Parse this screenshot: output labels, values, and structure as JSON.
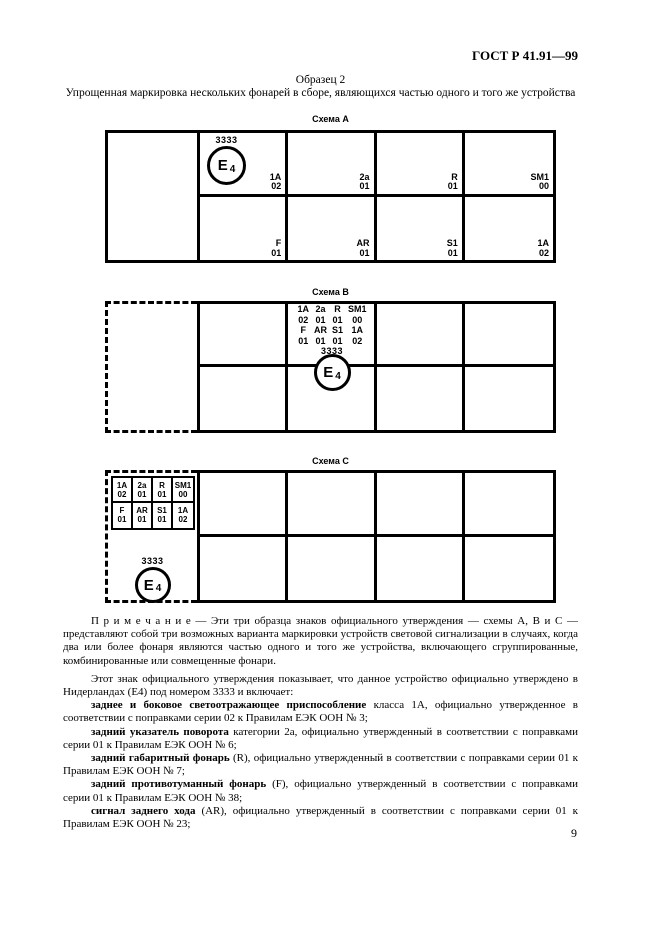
{
  "colors": {
    "ink": "#000000",
    "paper": "#ffffff"
  },
  "page": {
    "header": "ГОСТ Р 41.91—99",
    "page_number": "9"
  },
  "title": {
    "line1": "Образец 2",
    "line2": "Упрощенная маркировка нескольких фонарей в сборе, являющихся частью одного и того же устройства"
  },
  "emark": {
    "letter": "E",
    "country": "4"
  },
  "schema_a": {
    "title": "Схема А",
    "mark_number": "3333",
    "row1": [
      {
        "code": "1A",
        "num": "02"
      },
      {
        "code": "2a",
        "num": "01"
      },
      {
        "code": "R",
        "num": "01"
      },
      {
        "code": "SM1",
        "num": "00"
      }
    ],
    "row2": [
      {
        "code": "F",
        "num": "01"
      },
      {
        "code": "AR",
        "num": "01"
      },
      {
        "code": "S1",
        "num": "01"
      },
      {
        "code": "1A",
        "num": "02"
      }
    ]
  },
  "schema_b": {
    "title": "Схема В",
    "mark_number": "3333",
    "grid": [
      [
        "1A",
        "2a",
        "R",
        "SM1"
      ],
      [
        "02",
        "01",
        "01",
        "00"
      ],
      [
        "F",
        "AR",
        "S1",
        "1A"
      ],
      [
        "01",
        "01",
        "01",
        "02"
      ]
    ]
  },
  "schema_c": {
    "title": "Схема С",
    "mark_number": "3333",
    "row1": [
      {
        "code": "1A",
        "num": "02"
      },
      {
        "code": "2a",
        "num": "01"
      },
      {
        "code": "R",
        "num": "01"
      },
      {
        "code": "SM1",
        "num": "00"
      }
    ],
    "row2": [
      {
        "code": "F",
        "num": "01"
      },
      {
        "code": "AR",
        "num": "01"
      },
      {
        "code": "S1",
        "num": "01"
      },
      {
        "code": "1A",
        "num": "02"
      }
    ]
  },
  "note": {
    "text": "П р и м е ч а н и е — Эти три образца знаков официального утверждения — схемы А, В и С — представляют собой три возможных варианта маркировки устройств световой сигнализации в случаях, когда два или более фонаря являются частью одного и того же устройства, включающего сгруппированные, комбинированные или совмещенные фонари."
  },
  "body": {
    "intro": "Этот знак официального утверждения показывает, что данное устройство официально утверждено в Нидерландах (Е4) под номером 3333 и включает:",
    "items": [
      {
        "bold": "заднее и боковое светоотражающее приспособление",
        "rest": " класса 1А, официально утвержденное в соответствии с поправками серии 02 к Правилам ЕЭК ООН № 3;"
      },
      {
        "bold": "задний указатель поворота",
        "rest": " категории 2а, официально утвержденный в соответствии с поправками серии 01 к Правилам ЕЭК ООН № 6;"
      },
      {
        "bold": "задний габаритный фонарь",
        "rest": " (R), официально утвержденный в соответствии с поправками серии 01 к Правилам ЕЭК ООН № 7;"
      },
      {
        "bold": "задний противотуманный фонарь",
        "rest": " (F), официально утвержденный в соответствии с поправками серии 01 к Правилам ЕЭК ООН № 38;"
      },
      {
        "bold": "сигнал заднего хода",
        "rest": " (AR), официально утвержденный в соответствии с поправками серии 01 к Правилам ЕЭК ООН № 23;"
      }
    ]
  }
}
